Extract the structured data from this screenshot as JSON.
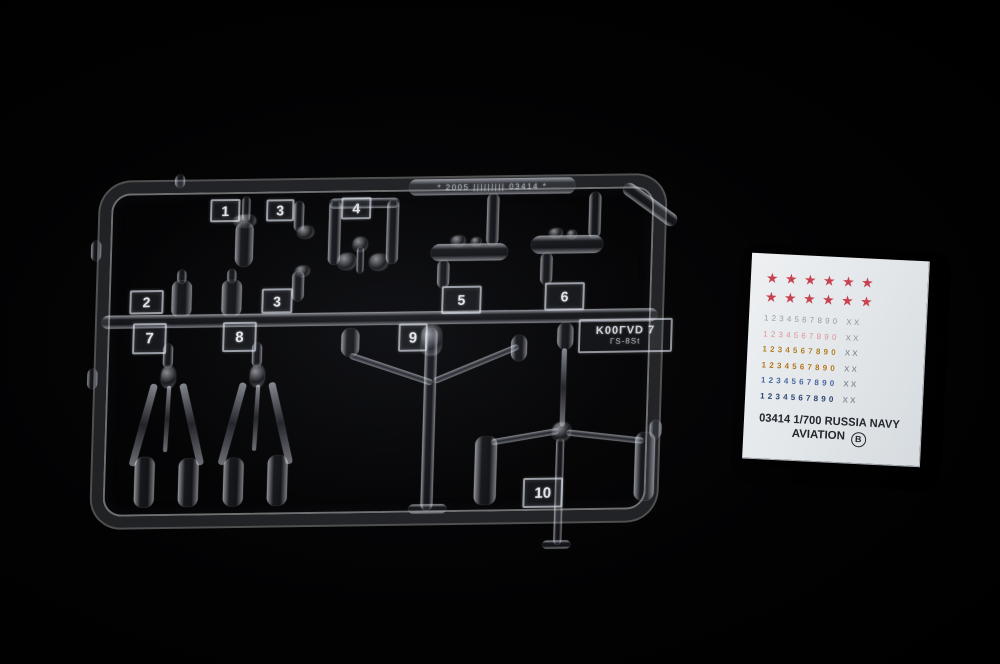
{
  "photo": {
    "background_color": "#020203"
  },
  "sprue": {
    "material": "clear plastic",
    "part_tags": [
      "1",
      "3",
      "4",
      "2",
      "3",
      "5",
      "6",
      "7",
      "8",
      "9",
      "10"
    ],
    "molded_text": "* 2005 ||||||||| 03414 *",
    "plate_text_line1": "K00ΓVD 7",
    "plate_text_line2": "ΓS-8St"
  },
  "decal": {
    "paper_color": "#e4e8eb",
    "star_row": "★★★★★★",
    "star_color": "#c8414e",
    "suffix_color": "#8d939b",
    "text_color": "#23272e",
    "digit_rows": [
      {
        "digits": "1234567890",
        "suffix": "XX",
        "color": "#949aa3"
      },
      {
        "digits": "1234567890",
        "suffix": "XX",
        "color": "#dd9096"
      },
      {
        "digits": "1234567890",
        "suffix": "XX",
        "color": "#aa7a20"
      },
      {
        "digits": "1234567890",
        "suffix": "XX",
        "color": "#b06f15"
      },
      {
        "digits": "1234567890",
        "suffix": "XX",
        "color": "#4a67a0"
      },
      {
        "digits": "1234567890",
        "suffix": "XX",
        "color": "#2a4474"
      }
    ],
    "title": "03414 1/700 RUSSIA NAVY",
    "subtitle": "AVIATION",
    "sheet_letter": "B"
  }
}
